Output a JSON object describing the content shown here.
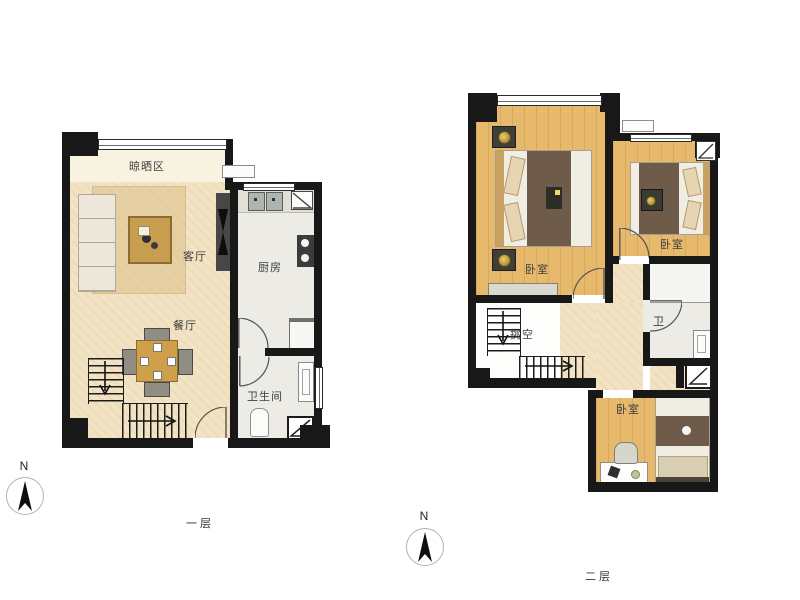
{
  "floor1": {
    "caption": "一层",
    "rooms": {
      "drying_area": "晾晒区",
      "living_room": "客厅",
      "kitchen": "厨房",
      "dining_room": "餐厅",
      "bathroom": "卫生间"
    }
  },
  "floor2": {
    "caption": "二层",
    "rooms": {
      "bedroom_main": "卧室",
      "bedroom_second": "卧室",
      "bedroom_third": "卧室",
      "void": "挑空",
      "bathroom": "卫"
    }
  },
  "compass": {
    "north_label": "N"
  },
  "palette": {
    "wall": "#181818",
    "wood_floor": "#e7b96d",
    "cream_floor": "#f1e3c3",
    "tile_floor": "#ecebe5",
    "balcony_floor": "#f8f3e1",
    "blanket": "#6f5b49",
    "background": "#ffffff"
  }
}
